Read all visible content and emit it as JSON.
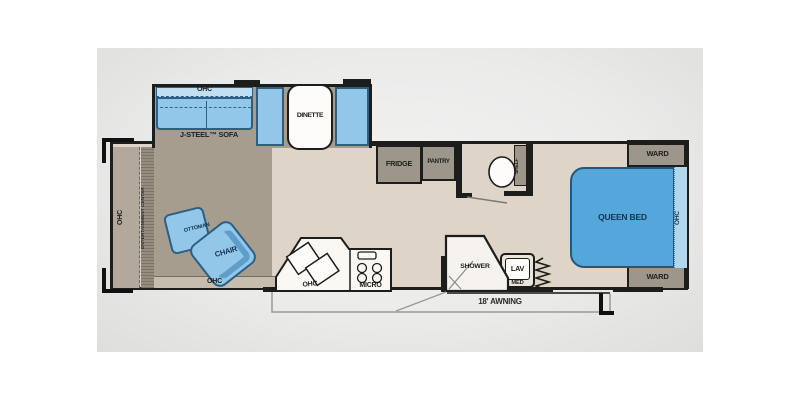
{
  "colors": {
    "wall": "#1d1d1b",
    "photo_background": "#ebebea",
    "floor_main": "#ded5c8",
    "floor_living": "#a79d8f",
    "cabinet_grey": "#9d968a",
    "furniture_blue": "#93c7e9",
    "furniture_blue_border": "#2d5f84",
    "ohc_light_blue": "#c2dff0",
    "bed_blue": "#55a7db",
    "counter_white": "#fbf8f3"
  },
  "labels": {
    "ohc_sofa": "OHC",
    "sofa": "J-STEEL™ SOFA",
    "dinette": "DINETTE",
    "fridge": "FRIDGE",
    "pantry": "PANTRY",
    "shelf": "SHELF",
    "ward_top": "WARD",
    "ward_bottom": "WARD",
    "queen_bed": "QUEEN BED",
    "ohc_bed": "OHC",
    "ohc_front": "OHC",
    "entertainment_center": "ENTERTAINMENT CENTER",
    "ottoman": "OTTOMAN",
    "chair": "CHAIR",
    "ohc_living": "OHC",
    "ohc_kitchen": "OHC",
    "micro": "MICRO",
    "shower": "SHOWER",
    "lav": "LAV",
    "med": "MED",
    "awning": "18' AWNING"
  }
}
